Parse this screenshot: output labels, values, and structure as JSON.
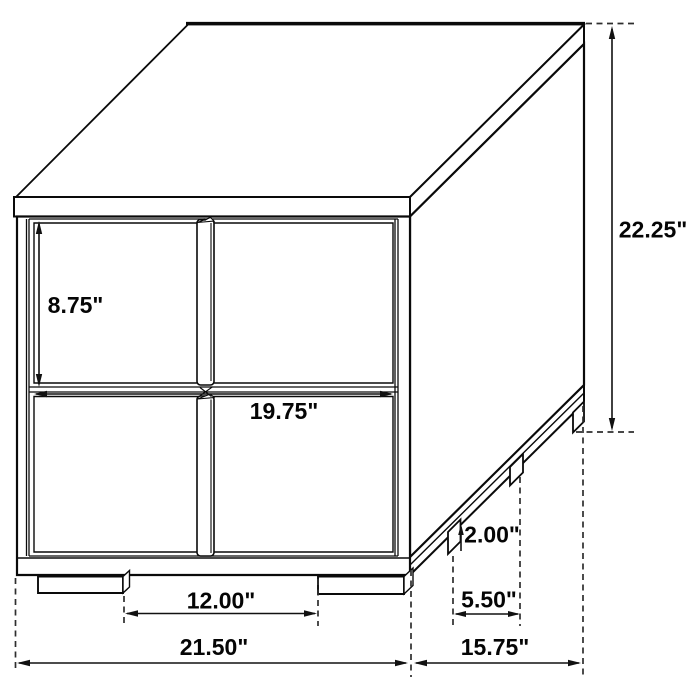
{
  "diagram": {
    "labels": {
      "overall_height": "22.25\"",
      "drawer_height": "8.75\"",
      "drawer_width": "19.75\"",
      "foot_height": "2.00\"",
      "side_foot_spacing": "5.50\"",
      "front_foot_spacing": "12.00\"",
      "overall_width": "21.50\"",
      "overall_depth": "15.75\""
    },
    "colors": {
      "line": "#0a0a0a",
      "dashed_line": "#2e2e2e",
      "text": "#050505",
      "background": "#ffffff"
    }
  }
}
